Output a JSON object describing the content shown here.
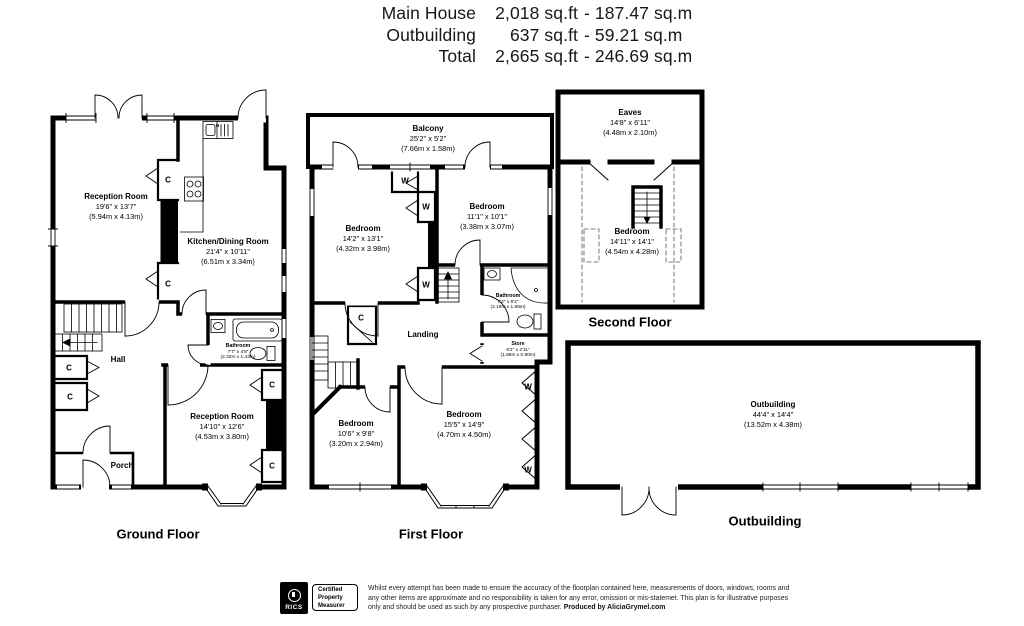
{
  "header": {
    "rows": [
      {
        "label": "Main House",
        "sqft": "2,018 sq.ft",
        "sqm": "- 187.47 sq.m"
      },
      {
        "label": "Outbuilding",
        "sqft": "637 sq.ft",
        "sqm": "- 59.21 sq.m"
      },
      {
        "label": "Total",
        "sqft": "2,665 sq.ft",
        "sqm": "- 246.69 sq.m"
      }
    ]
  },
  "markers": {
    "closet": "C",
    "wardrobe": "W"
  },
  "floors": {
    "ground": {
      "title": "Ground Floor",
      "rooms": {
        "reception1": {
          "name": "Reception Room",
          "dims": "19'6\" x 13'7\"",
          "metric": "(5.94m x 4.13m)"
        },
        "kitchen": {
          "name": "Kitchen/Dining Room",
          "dims": "21'4\" x 10'11\"",
          "metric": "(6.51m x 3.34m)"
        },
        "hall": {
          "name": "Hall"
        },
        "bathroom": {
          "name": "Bathroom",
          "dims": "7'7\" x 4'8\"",
          "metric": "(2.32m x 1.43m)"
        },
        "reception2": {
          "name": "Reception Room",
          "dims": "14'10\" x 12'6\"",
          "metric": "(4.53m x 3.80m)"
        },
        "porch": {
          "name": "Porch"
        }
      }
    },
    "first": {
      "title": "First Floor",
      "rooms": {
        "balcony": {
          "name": "Balcony",
          "dims": "25'2\" x 5'2\"",
          "metric": "(7.66m x 1.58m)"
        },
        "bedroom1": {
          "name": "Bedroom",
          "dims": "14'2\" x 13'1\"",
          "metric": "(4.32m x 3.98m)"
        },
        "bedroom2": {
          "name": "Bedroom",
          "dims": "11'1\" x 10'1\"",
          "metric": "(3.38m x 3.07m)"
        },
        "bathroom": {
          "name": "Bathroom",
          "dims": "7'2\" x 6'2\"",
          "metric": "(2.19m x 1.88m)"
        },
        "landing": {
          "name": "Landing"
        },
        "store": {
          "name": "Store",
          "dims": "6'2\" x 2'11\"",
          "metric": "(1.88m x 0.90m)"
        },
        "bedroom3": {
          "name": "Bedroom",
          "dims": "10'6\" x 9'8\"",
          "metric": "(3.20m x 2.94m)"
        },
        "bedroom4": {
          "name": "Bedroom",
          "dims": "15'5\" x 14'9\"",
          "metric": "(4.70m x 4.50m)"
        }
      }
    },
    "second": {
      "title": "Second Floor",
      "rooms": {
        "eaves": {
          "name": "Eaves",
          "dims": "14'8\" x 6'11\"",
          "metric": "(4.48m x 2.10m)"
        },
        "bedroom": {
          "name": "Bedroom",
          "dims": "14'11\" x 14'1\"",
          "metric": "(4.54m x 4.28m)"
        }
      }
    },
    "outbuilding": {
      "title": "Outbuilding",
      "rooms": {
        "outbuilding": {
          "name": "Outbuilding",
          "dims": "44'4\" x 14'4\"",
          "metric": "(13.52m x 4.38m)"
        }
      }
    }
  },
  "footer": {
    "rics": {
      "brand": "RICS",
      "badge_line1": "Certified",
      "badge_line2": "Property",
      "badge_line3": "Measurer"
    },
    "disclaimer_line1": "Whilst every attempt has been made to ensure the accuracy of the floorplan contained here, measurements of doors, windows, rooms",
    "disclaimer_line2": "and any other items are approximate and no responsibility is taken for any error, omission or mis-statemet. This plan is for illustrative",
    "disclaimer_line3": "purposes only and should be used as such by any prospective purchaser.",
    "produced_by": "Produced by AliciaGrymel.com"
  }
}
